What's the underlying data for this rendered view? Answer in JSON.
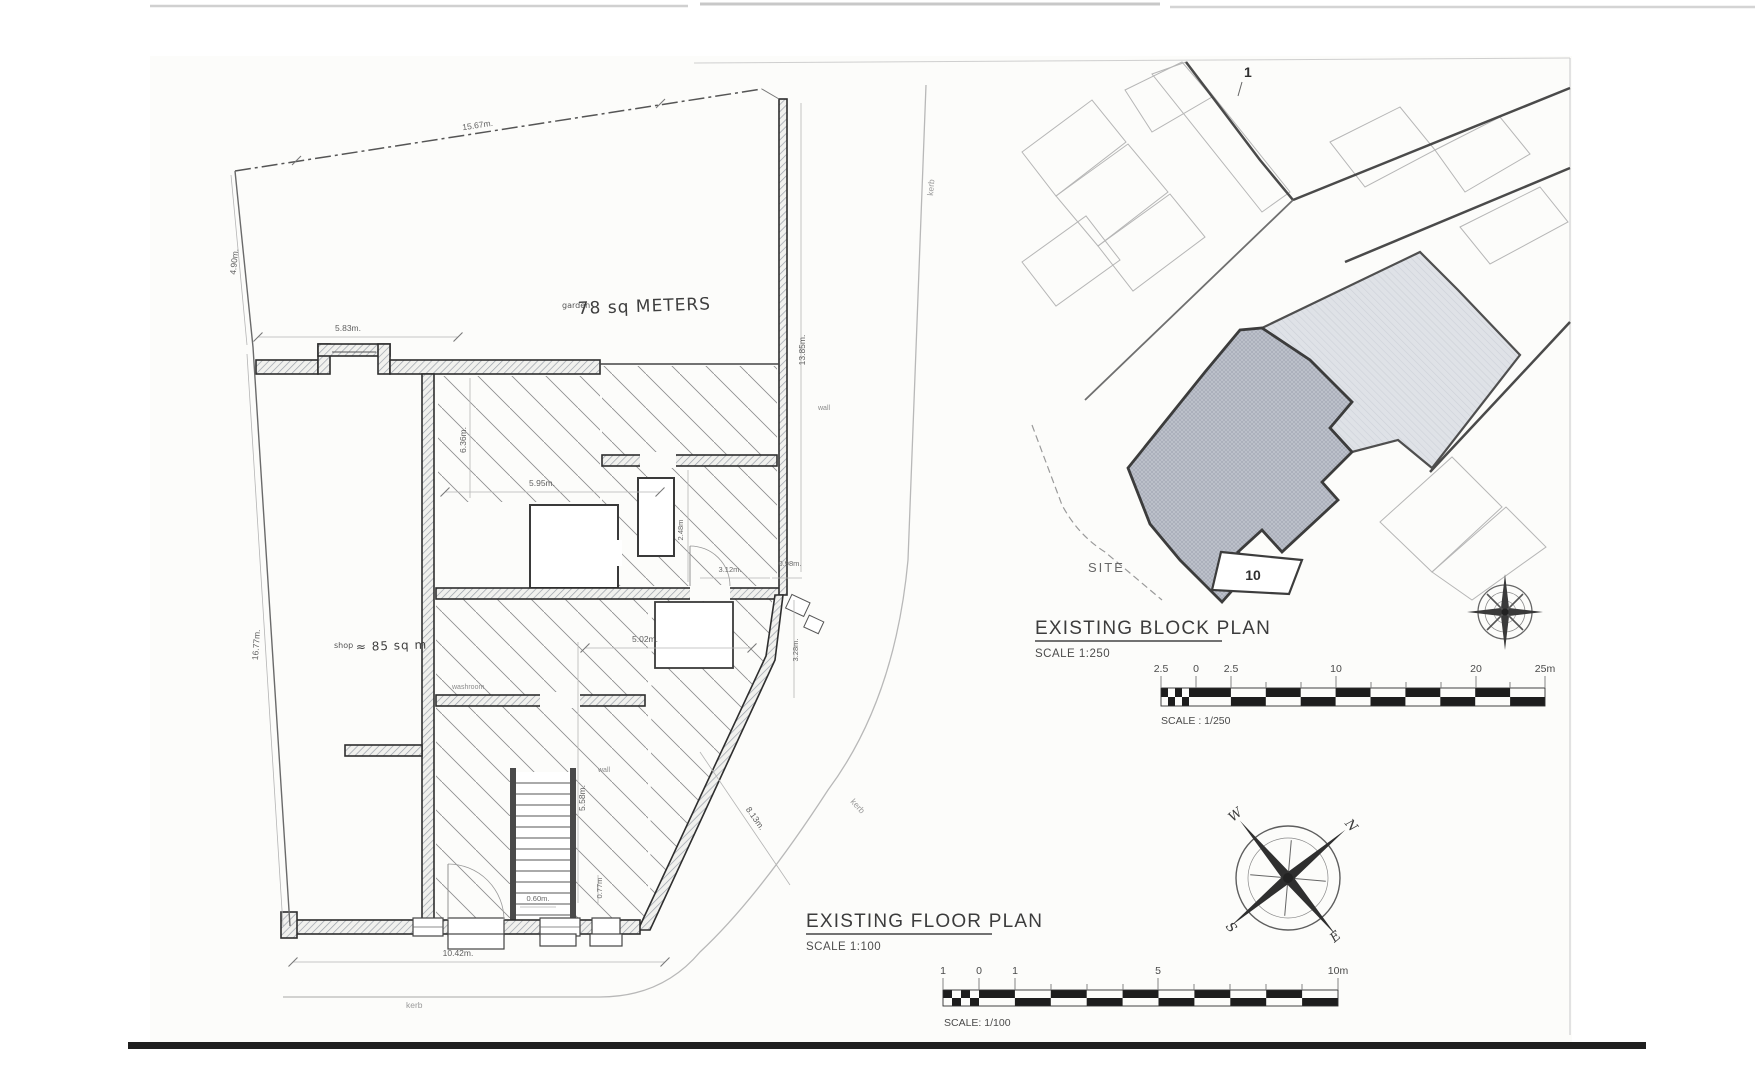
{
  "fp": {
    "title": "EXISTING FLOOR PLAN",
    "scale": "SCALE 1:100",
    "garden_small": "garden",
    "garden_big": "78 sq METERS",
    "shop_small": "shop",
    "shop_big": "≈ 85 sq m",
    "washroom": "washroom",
    "wall_note": "wall",
    "stair_note": "wall",
    "kerb": "kerb",
    "dims": {
      "top": "15.67m.",
      "left_upper": "4.90m.",
      "left_lower": "16.77m.",
      "garden_w": "5.83m.",
      "garden_d": "13.85m.",
      "mid_v": "6.36m.",
      "mid_h": "5.95m.",
      "rear_v": "2.48m",
      "rear_h1": "3.12m.",
      "rear_h2": "0.98m.",
      "side_v": "3.28m.",
      "rear_room": "5.02m.",
      "stair_v": "5.58m.",
      "diag": "8.13m.",
      "step_w": "0.60m.",
      "step_d": "0.77m",
      "bottom": "10.42m."
    }
  },
  "bp": {
    "title": "EXISTING BLOCK PLAN",
    "scale": "SCALE 1:250",
    "site": "SITE",
    "house_no": "10",
    "plot_no": "1"
  },
  "sb250": {
    "labels": [
      "2.5",
      "0",
      "2.5",
      "10",
      "20",
      "25m"
    ],
    "caption": "SCALE : 1/250"
  },
  "sb100": {
    "labels": [
      "1",
      "0",
      "1",
      "5",
      "10m"
    ],
    "caption": "SCALE: 1/100"
  },
  "compass": {
    "n": "N",
    "e": "E",
    "s": "S",
    "w": "W"
  }
}
